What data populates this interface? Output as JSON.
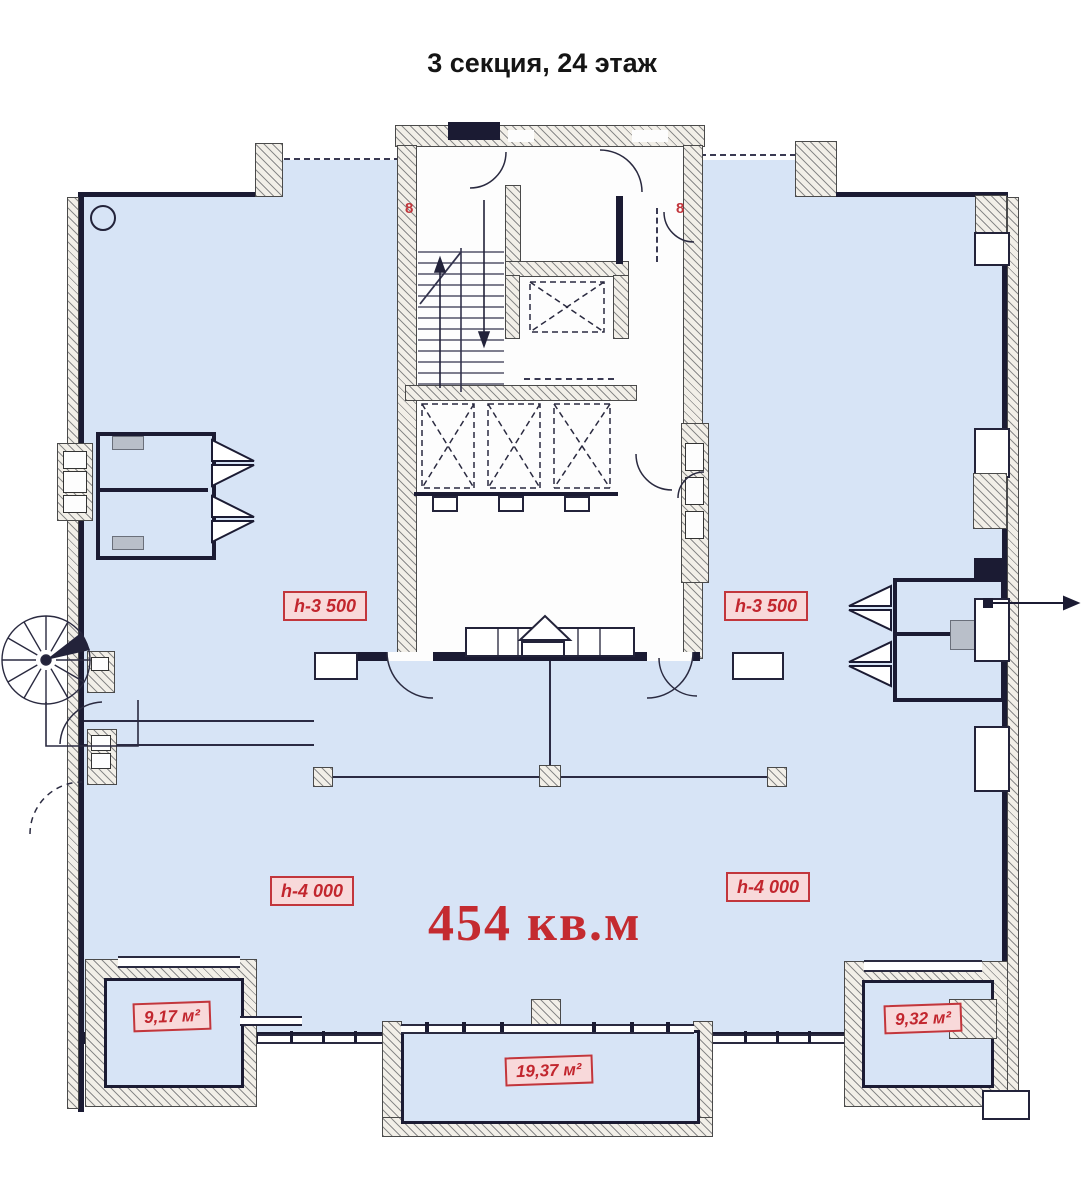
{
  "title": "3 секция, 24 этаж",
  "areas": {
    "total": "454 кв.м",
    "balcony_left": "9,17 м²",
    "balcony_center": "19,37 м²",
    "balcony_right": "9,32 м²"
  },
  "heights": {
    "upper_left": "h-3 500",
    "upper_right": "h-3 500",
    "lower_left": "h-4 000",
    "lower_right": "h-4 000"
  },
  "axis": {
    "left": "8",
    "right": "8"
  },
  "colors": {
    "floor": "#d7e4f6",
    "wall": "#1b1b33",
    "hatch_bg": "#f2efe8",
    "accent_red": "#c32b31",
    "label_bg": "#f8d9da"
  }
}
